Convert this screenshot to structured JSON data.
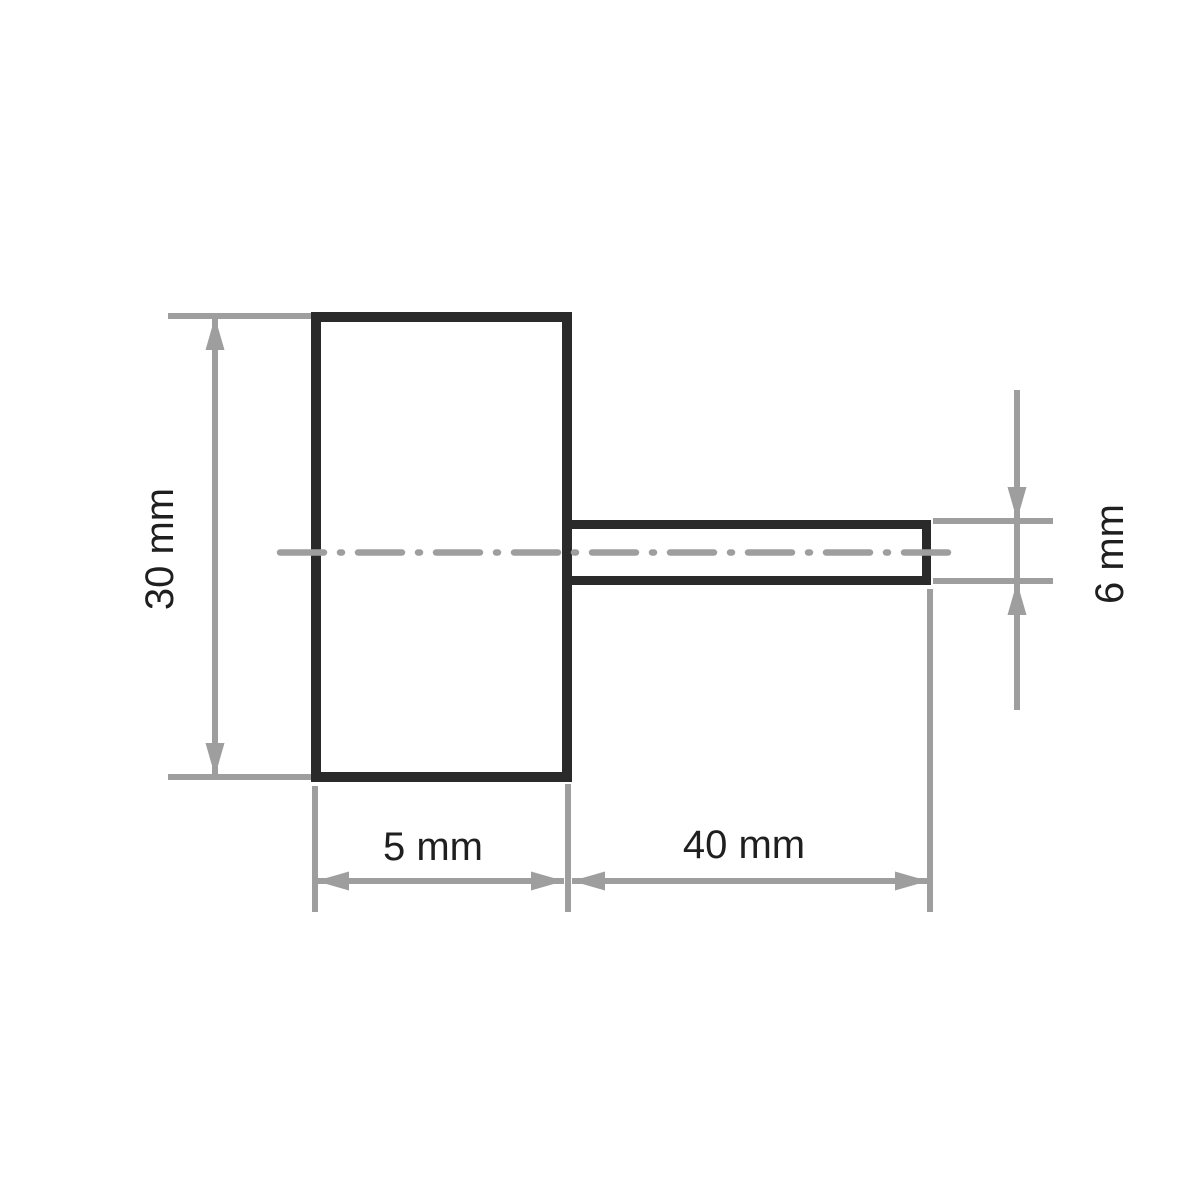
{
  "colors": {
    "line_black": "#2a2a2a",
    "line_gray": "#9e9e9e",
    "text": "#1f1f1f",
    "background": "#ffffff"
  },
  "drawing": {
    "type": "technical-dimension-drawing",
    "view": "side view of wheel body with cylindrical shank",
    "dimensions": {
      "wheel_diameter": {
        "label": "30 mm",
        "value": 30,
        "unit": "mm"
      },
      "wheel_width": {
        "label": "5 mm",
        "value": 5,
        "unit": "mm"
      },
      "shank_length": {
        "label": "40 mm",
        "value": 40,
        "unit": "mm"
      },
      "shank_diameter": {
        "label": "6 mm",
        "value": 6,
        "unit": "mm"
      }
    }
  }
}
